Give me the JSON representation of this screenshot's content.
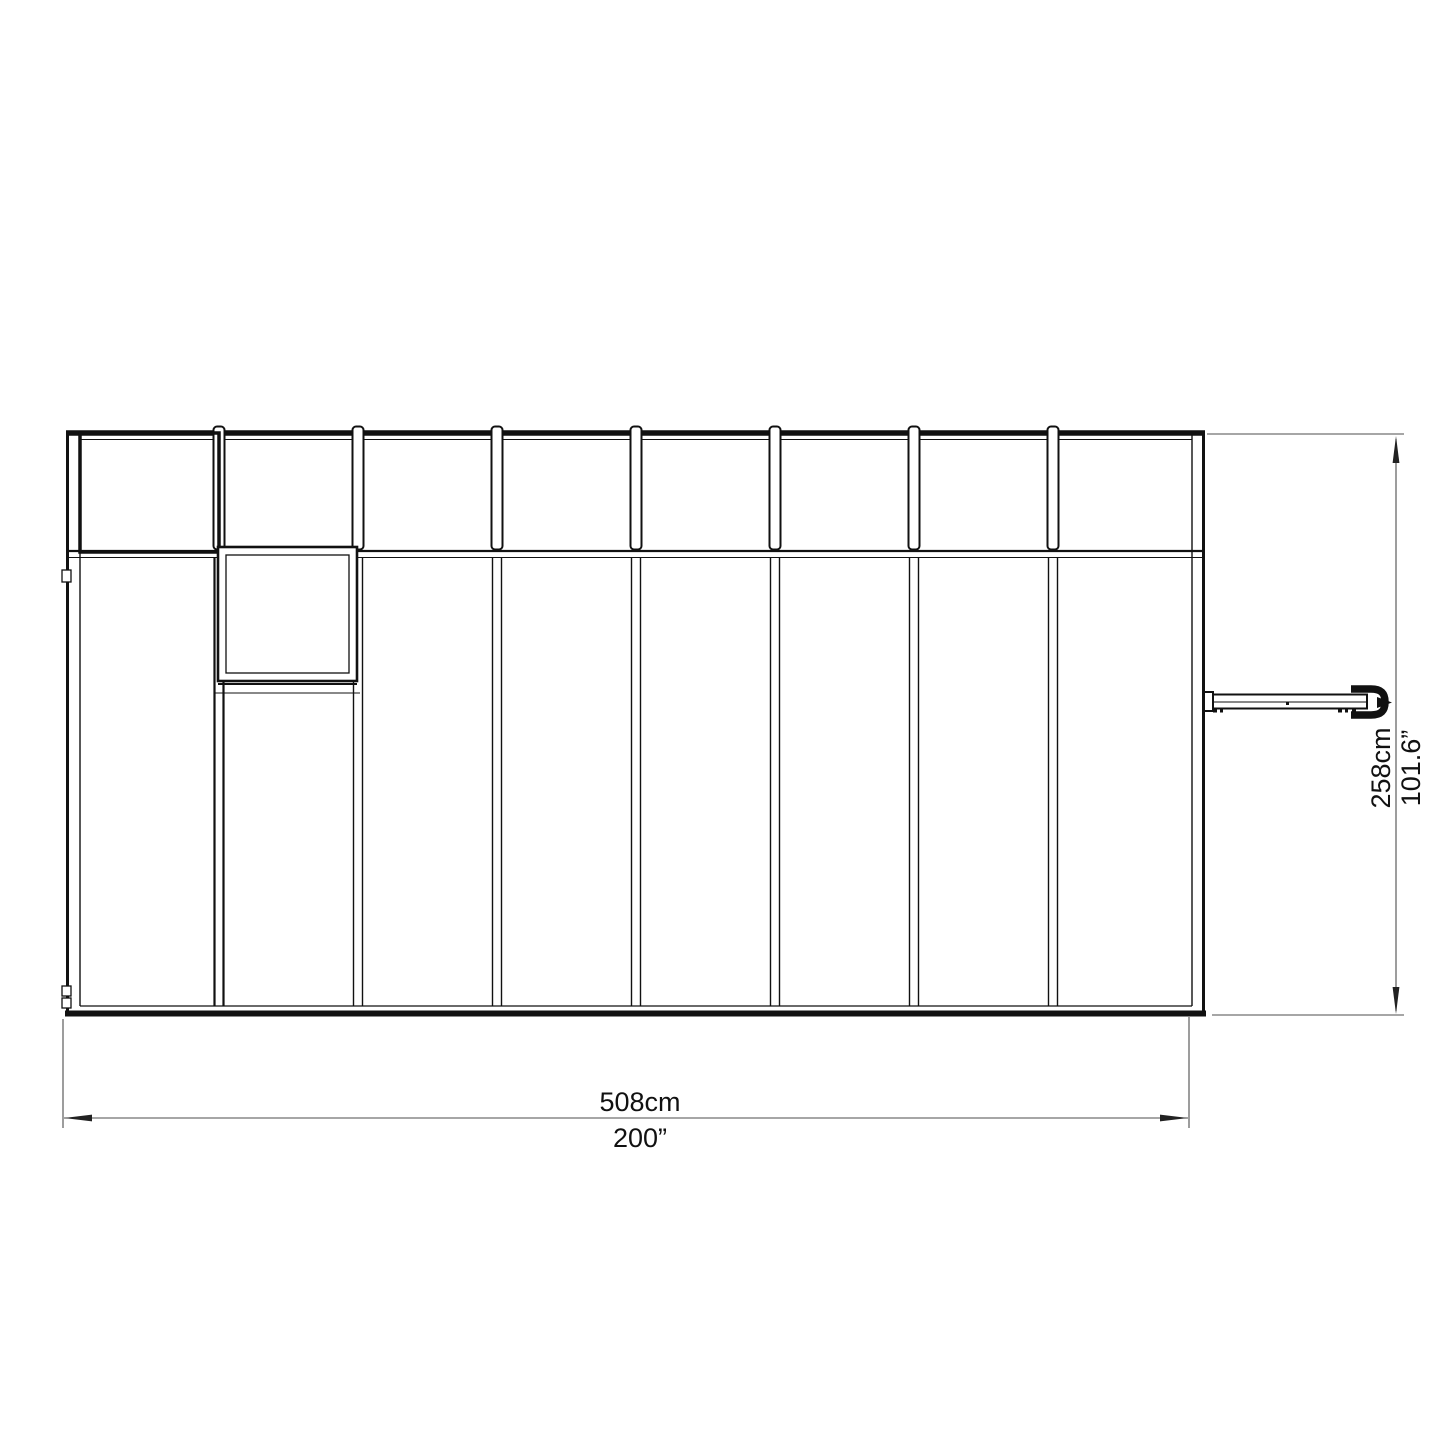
{
  "diagram": {
    "background": "#ffffff",
    "line_color": "#111111",
    "dimension_line_color": "#4d4d4d"
  },
  "structure": {
    "bay_count": 8,
    "has_window_vent": true,
    "has_door_handle": true
  },
  "dimensions": {
    "width_cm": "508cm",
    "width_in": "200”",
    "height_cm": "258cm",
    "height_in": "101.6”"
  }
}
